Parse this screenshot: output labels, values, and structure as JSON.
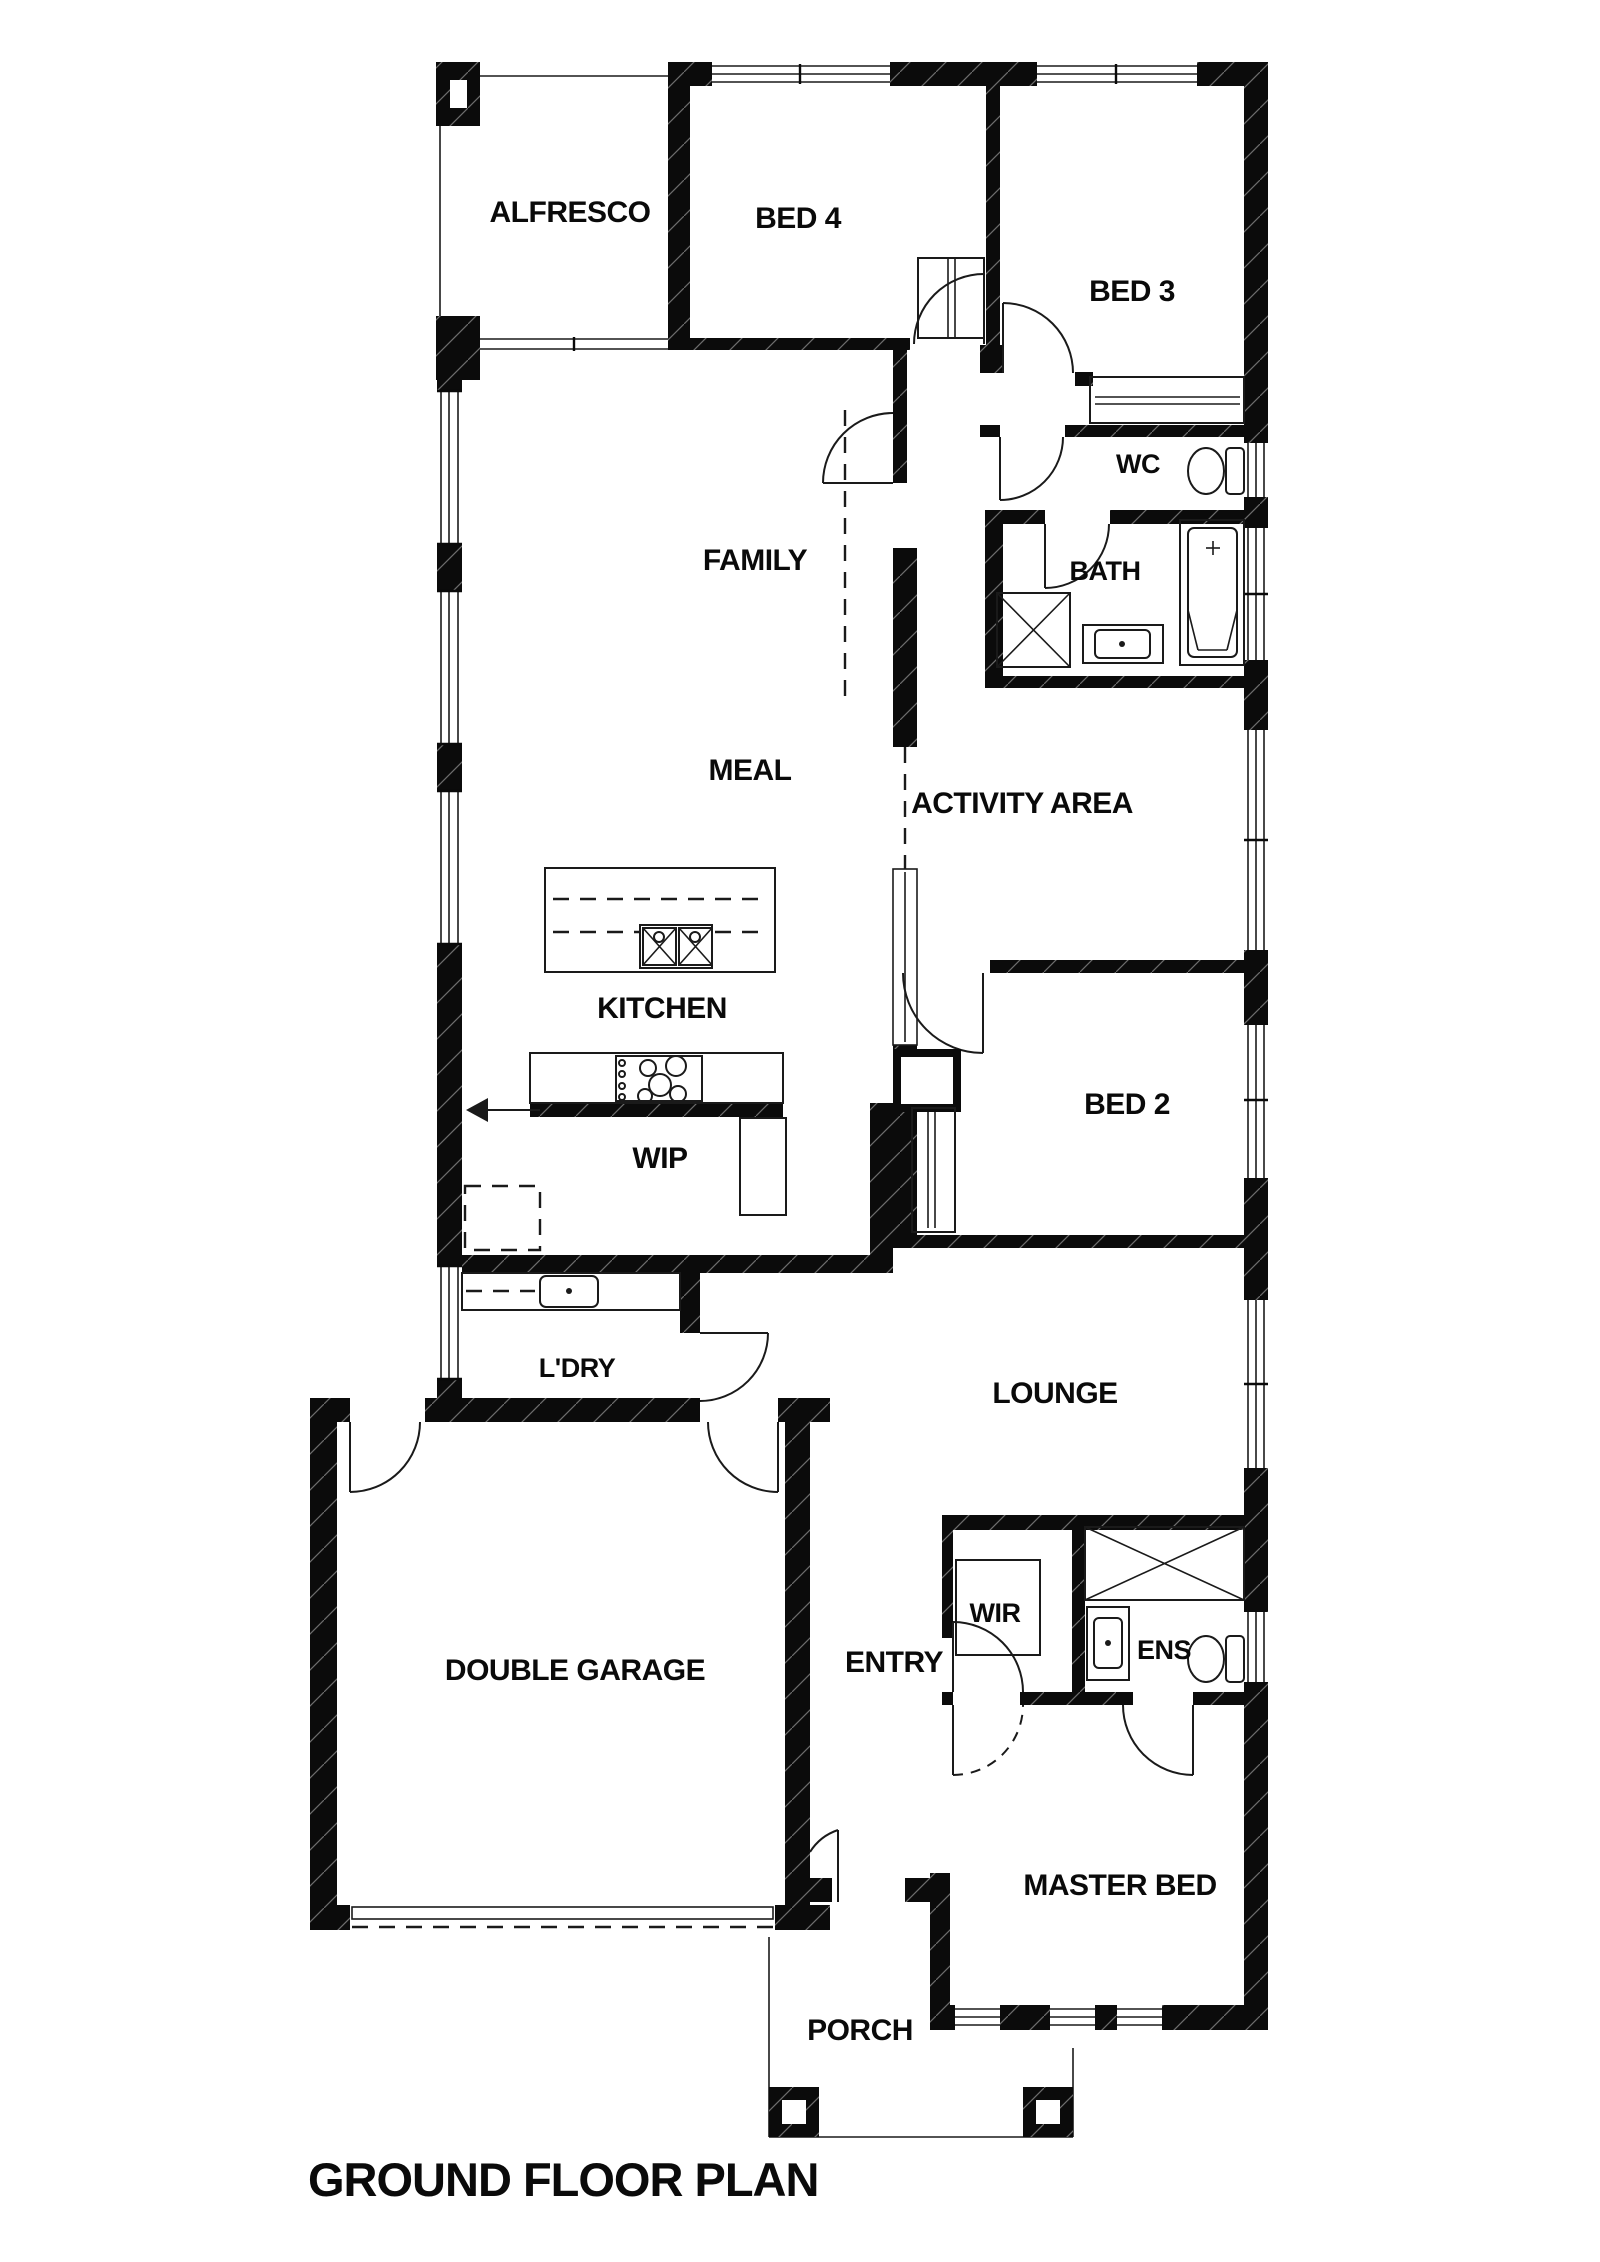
{
  "plan": {
    "title": "GROUND FLOOR PLAN",
    "colors": {
      "wall": "#0b0b0b",
      "background": "#ffffff",
      "line": "#1a1a1a"
    },
    "rooms": [
      {
        "label": "ALFRESCO"
      },
      {
        "label": "BED 4"
      },
      {
        "label": "BED 3"
      },
      {
        "label": "FAMILY"
      },
      {
        "label": "WC"
      },
      {
        "label": "BATH"
      },
      {
        "label": "MEAL"
      },
      {
        "label": "ACTIVITY AREA"
      },
      {
        "label": "KITCHEN"
      },
      {
        "label": "BED 2"
      },
      {
        "label": "WIP"
      },
      {
        "label": "L'DRY"
      },
      {
        "label": "LOUNGE"
      },
      {
        "label": "WIR"
      },
      {
        "label": "ENS"
      },
      {
        "label": "ENTRY"
      },
      {
        "label": "DOUBLE GARAGE"
      },
      {
        "label": "MASTER BED"
      },
      {
        "label": "PORCH"
      }
    ]
  }
}
